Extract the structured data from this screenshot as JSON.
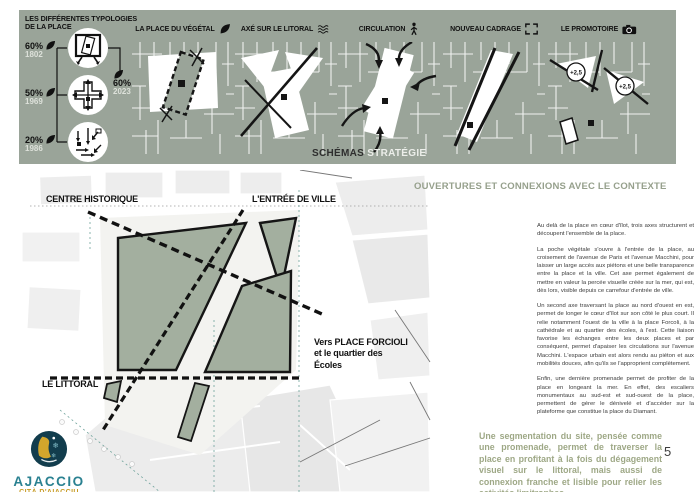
{
  "banner": {
    "typologies": {
      "heading": "LES DIFFÉRENTES TYPOLOGIES\nDE LA PLACE",
      "stats": [
        {
          "pct": "60%",
          "year": "1802"
        },
        {
          "pct": "50%",
          "year": "1969"
        },
        {
          "pct": "20%",
          "year": "1986"
        }
      ],
      "result": {
        "pct": "60%",
        "year": "2023"
      }
    },
    "panels": [
      {
        "label": "LA PLACE DU VÉGÉTAL"
      },
      {
        "label": "AXÉ SUR LE LITORAL"
      },
      {
        "label": "CIRCULATION"
      },
      {
        "label": "NOUVEAU CADRAGE"
      },
      {
        "label": "LE PROMOTOIRE"
      }
    ],
    "promontory_badges": [
      "+2,5",
      "+2,5"
    ],
    "caption": {
      "bold": "SCHÉMAS",
      "light": "STRATÉGIE"
    }
  },
  "plan": {
    "labels": {
      "centre_historique": "CENTRE HISTORIQUE",
      "entree_de_ville": "L'ENTRÉE DE VILLE",
      "vers_forcioli": "Vers PLACE FORCIOLI\net le quartier des\nÉcoles",
      "le_littoral": "LE LITTORAL"
    }
  },
  "content": {
    "title": "OUVERTURES ET CONNEXIONS AVEC LE CONTEXTE",
    "paragraphs": [
      "Au delà de la place en cœur d'îlot, trois axes structurent et découpent l'ensemble de la place.",
      "La poche végétale s'ouvre à l'entrée de la place, au croisement de l'avenue de Paris et l'avenue Macchini, pour laisser un large accès aux piétons et une belle transparence entre la place et la ville. Cet axe permet également de mettre en valeur la percée visuelle créée sur la mer, qui est, dès lors, visible depuis ce carrefour d'entrée de ville.",
      "Un second axe traversant la place au nord d'ouest en est, permet de longer le cœur d'îlot sur son côté le plus court. Il relie notamment l'ouest de la ville à la place Forcoli, à la cathédrale et au quartier des écoles, à l'est. Cette liaison favorise les échanges entre les deux places et par conséquent, permet d'apaiser les circulations sur l'avenue Macchini. L'espace urbain est alors rendu au piéton et aux mobilités douces, afin qu'ils se l'approprient complètement.",
      "Enfin, une dernière promenade permet de profiter de la place en longeant la mer. En effet, des escaliers monumentaux au sud-est et sud-ouest de la place, permettent de gérer le dénivelé et d'accéder sur la plateforme que constitue la place du Diamant."
    ],
    "highlight": "Une segmentation du site, pensée comme une promenade, permet de traverser la place en profitant à la fois du dégagement visuel sur le littoral, mais aussi de connexion franche et lisible pour relier les activités limitrophes.",
    "page_number": "5"
  },
  "logo": {
    "title": "AJACCIO",
    "subtitle": "CITÀ D'AIACCIU"
  }
}
